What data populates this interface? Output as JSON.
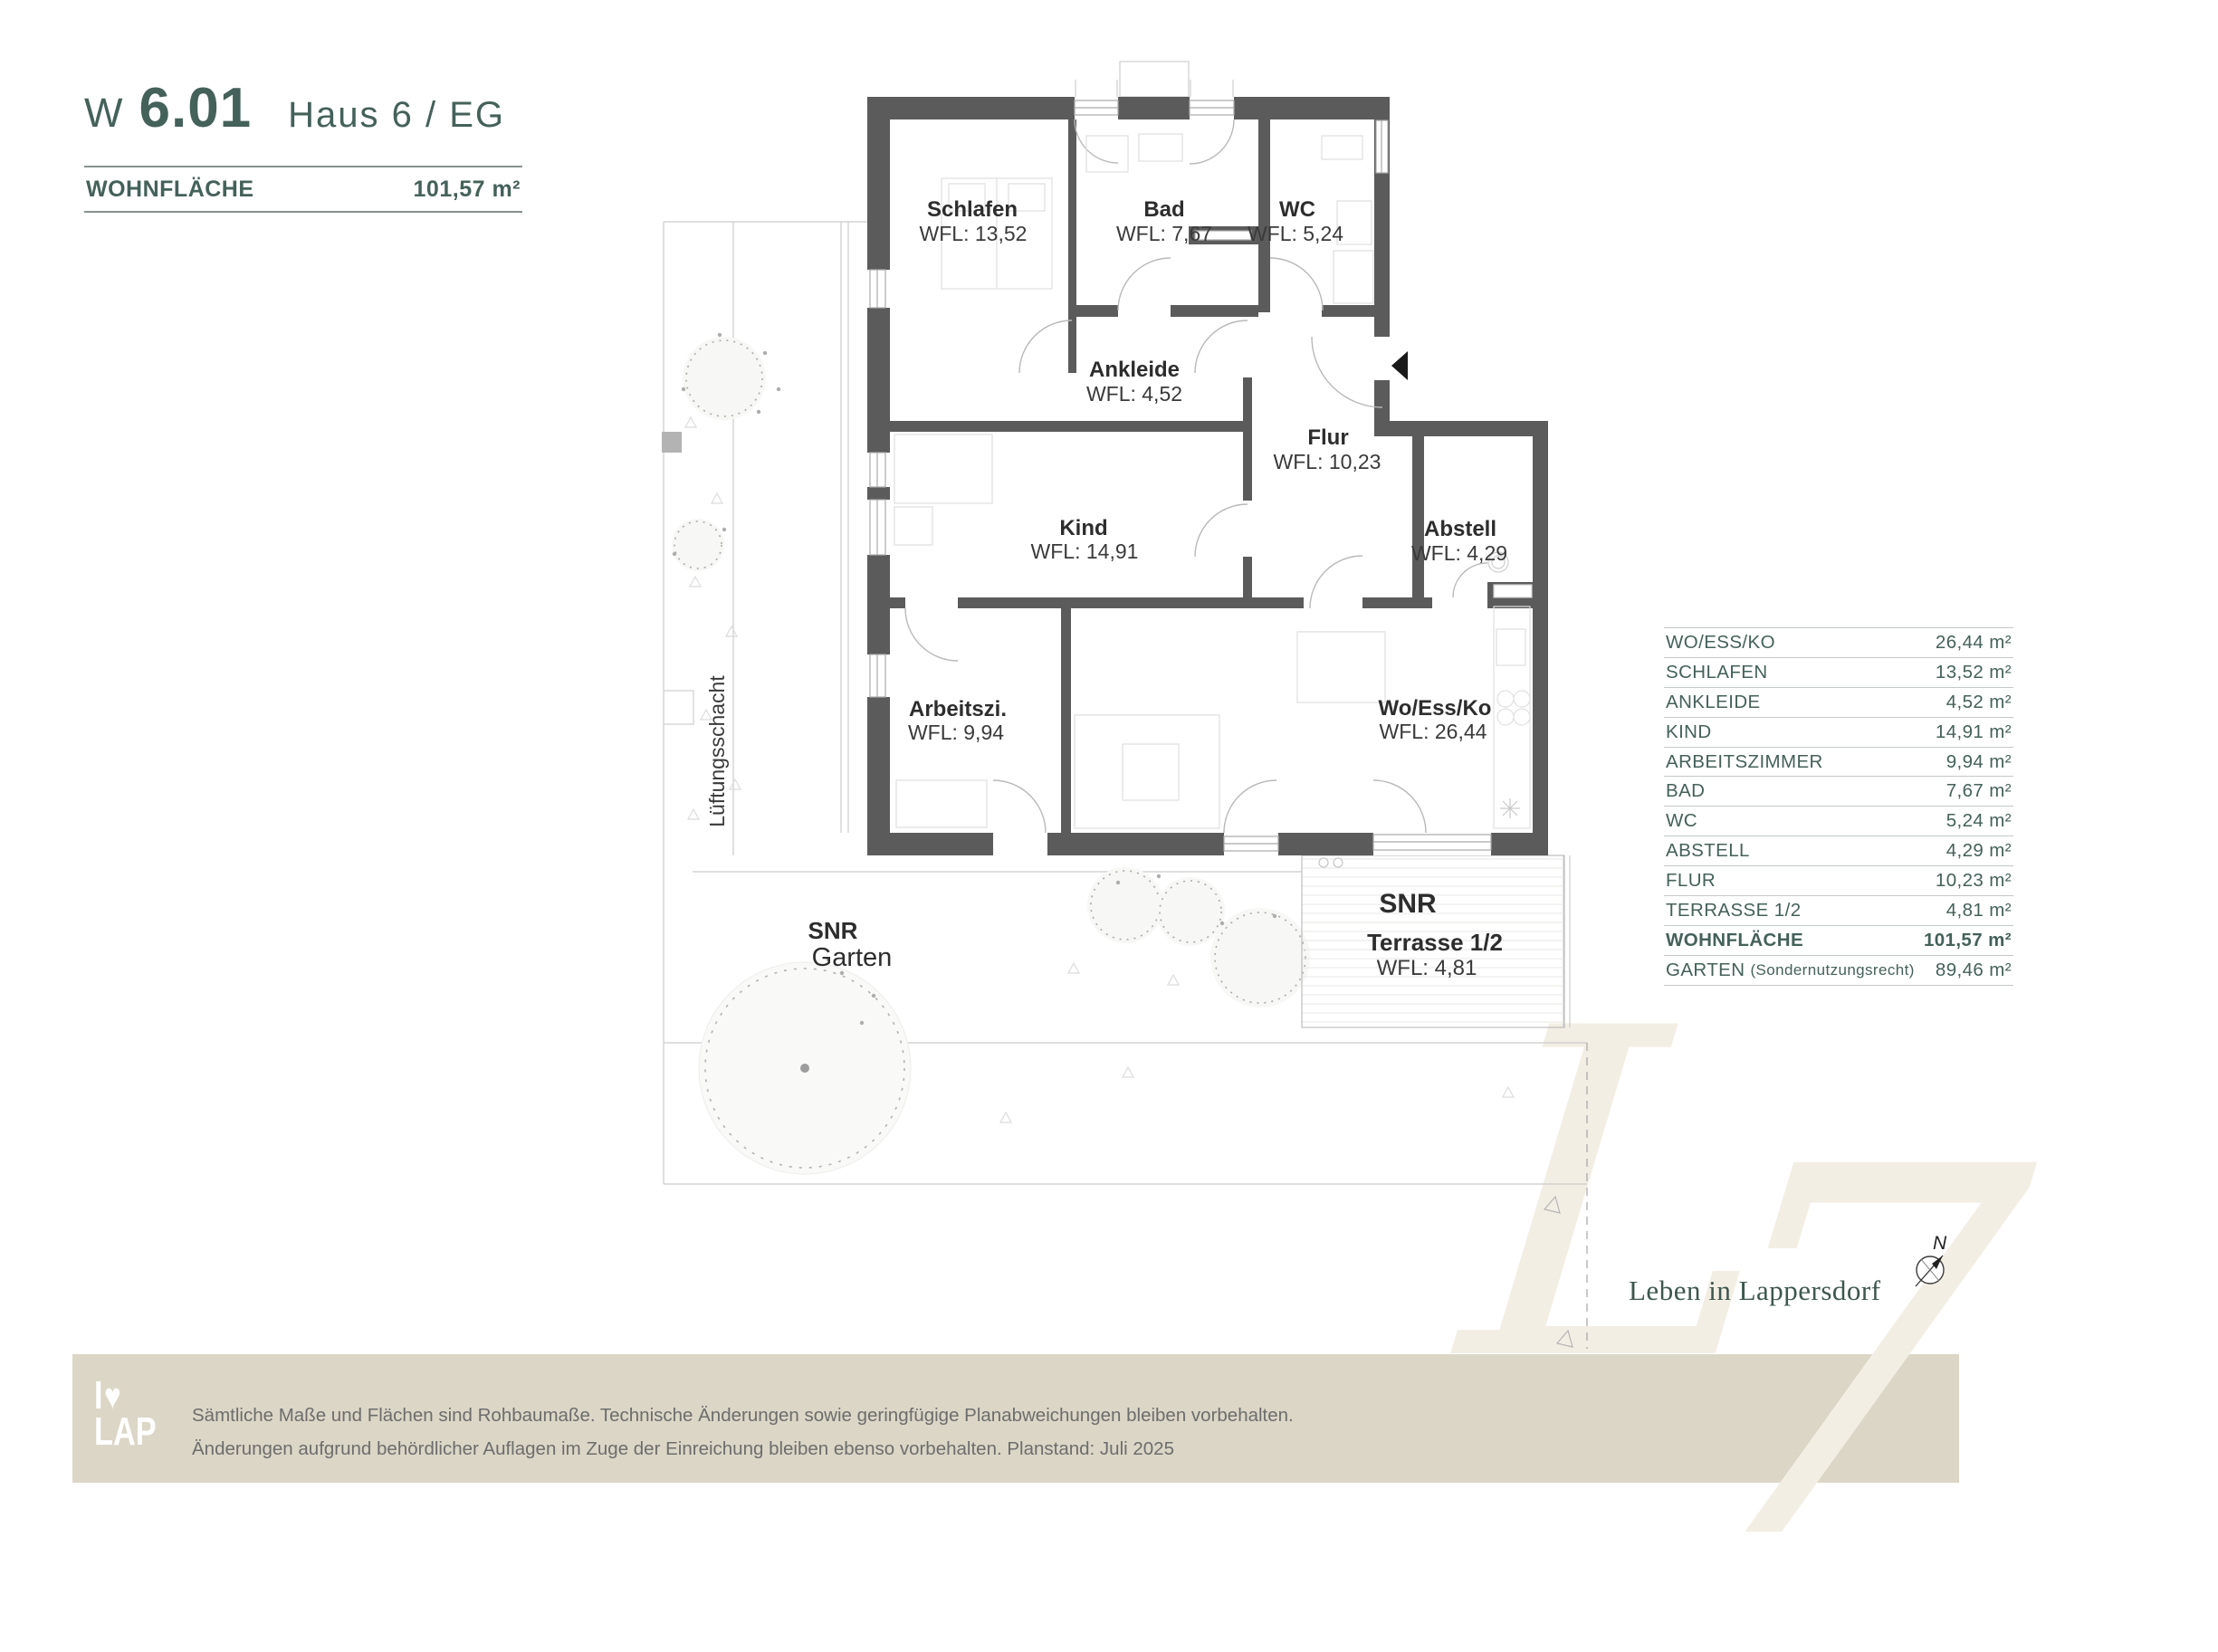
{
  "title": {
    "prefix": "W",
    "code": "6.01",
    "building": "Haus 6 / EG"
  },
  "area_header": {
    "label": "WOHNFLÄCHE",
    "value": "101,57 m²"
  },
  "rooms": [
    {
      "name": "Schlafen",
      "wfl": "WFL: 13,52"
    },
    {
      "name": "Bad",
      "wfl": "WFL: 7,67"
    },
    {
      "name": "WC",
      "wfl": "WFL: 5,24"
    },
    {
      "name": "Ankleide",
      "wfl": "WFL: 4,52"
    },
    {
      "name": "Flur",
      "wfl": "WFL: 10,23"
    },
    {
      "name": "Kind",
      "wfl": "WFL: 14,91"
    },
    {
      "name": "Abstell",
      "wfl": "WFL: 4,29"
    },
    {
      "name": "Arbeitszi.",
      "wfl": "WFL: 9,94"
    },
    {
      "name": "Wo/Ess/Ko",
      "wfl": "WFL: 26,44"
    }
  ],
  "outdoor": {
    "garden_tag": "SNR",
    "garden_name": "Garten",
    "terrace_tag": "SNR",
    "terrace_name": "Terrasse 1/2",
    "terrace_wfl": "WFL: 4,81",
    "shaft_label": "Lüftungsschacht"
  },
  "compass": {
    "north_label": "N"
  },
  "area_table": {
    "rows": [
      {
        "label": "WO/ESS/KO",
        "value": "26,44 m²"
      },
      {
        "label": "SCHLAFEN",
        "value": "13,52 m²"
      },
      {
        "label": "ANKLEIDE",
        "value": "4,52 m²"
      },
      {
        "label": "KIND",
        "value": "14,91 m²"
      },
      {
        "label": "ARBEITSZIMMER",
        "value": "9,94 m²"
      },
      {
        "label": "BAD",
        "value": "7,67 m²"
      },
      {
        "label": "WC",
        "value": "5,24 m²"
      },
      {
        "label": "ABSTELL",
        "value": "4,29 m²"
      },
      {
        "label": "FLUR",
        "value": "10,23 m²"
      },
      {
        "label": "TERRASSE 1/2",
        "value": "4,81 m²"
      },
      {
        "label": "WOHNFLÄCHE",
        "value": "101,57 m²"
      },
      {
        "label": "GARTEN",
        "note": "(Sondernutzungsrecht)",
        "value": "89,46 m²"
      }
    ]
  },
  "brand": {
    "tagline": "Leben in Lappersdorf",
    "watermark_l": "L",
    "watermark_seven": "7",
    "logo_top": "I",
    "logo_heart": "♥",
    "logo_bottom": "LAP"
  },
  "footer": {
    "disclaimer_line1": "Sämtliche Maße und Flächen sind Rohbaumaße. Technische Änderungen sowie geringfügige Planabweichungen bleiben vorbehalten.",
    "disclaimer_line2": "Änderungen aufgrund behördlicher Auflagen im Zuge der Einreichung bleiben ebenso vorbehalten. Planstand: Juli 2025"
  },
  "colors": {
    "accent_green": "#44615a",
    "wall_gray": "#5b5b5b",
    "footer_band": "#dcd6c7",
    "watermark_cream": "#f3eee4"
  }
}
